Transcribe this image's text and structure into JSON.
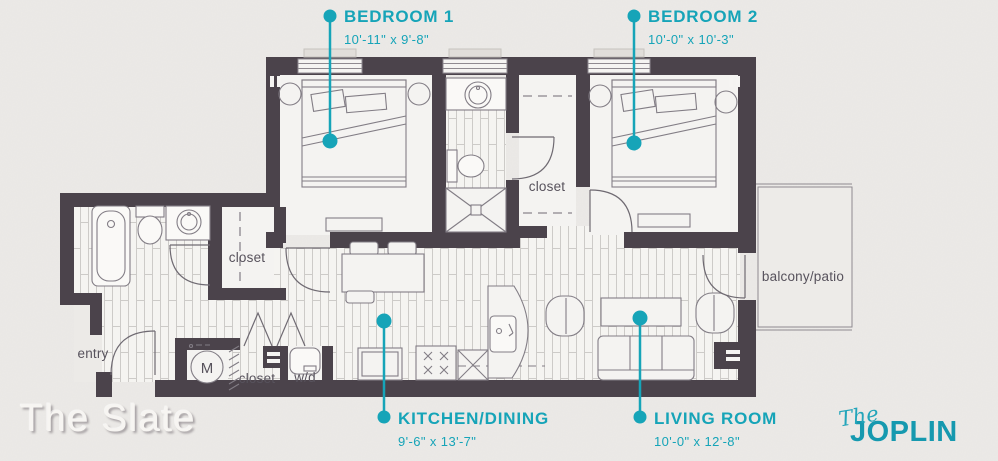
{
  "branding": {
    "plan_name": "The Slate",
    "property": {
      "prefix": "The",
      "name": "JOPLIN"
    }
  },
  "callouts": {
    "bedroom1": {
      "label": "BEDROOM 1",
      "dimensions": "10'-11\" x 9'-8\""
    },
    "bedroom2": {
      "label": "BEDROOM 2",
      "dimensions": "10'-0\" x 10'-3\""
    },
    "kitchen_dining": {
      "label": "KITCHEN/DINING",
      "dimensions": "9'-6\" x 13'-7\""
    },
    "living_room": {
      "label": "LIVING ROOM",
      "dimensions": "10'-0\" x 12'-8\""
    }
  },
  "room_labels": {
    "closet_hall": "closet",
    "closet_walkin": "closet",
    "closet_laundry": "closet",
    "entry": "entry",
    "balcony": "balcony/patio",
    "washer_dryer": "w/d",
    "mechanical": "M"
  },
  "colors": {
    "accent": "#16A4B8",
    "wall": "#4B434B",
    "paper": "#ECEAE7",
    "label_gray": "#57525C"
  }
}
